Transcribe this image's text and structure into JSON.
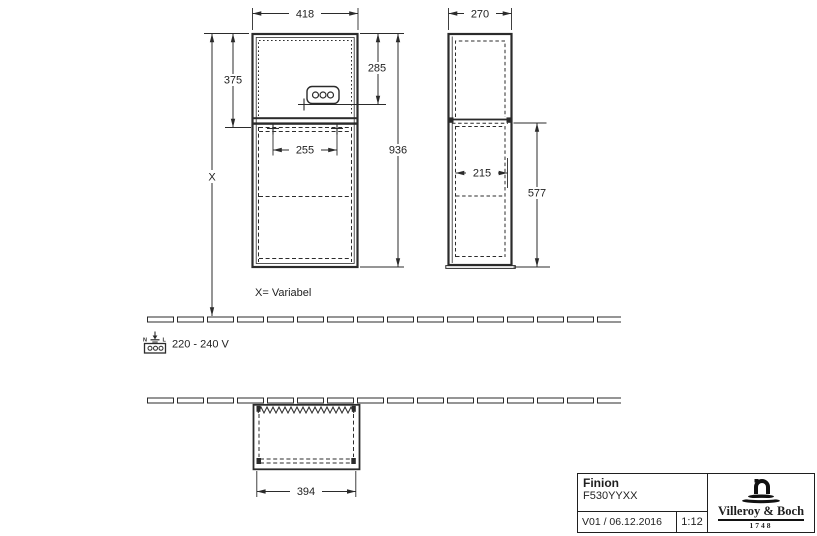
{
  "drawing": {
    "front_view": {
      "width_mm": "418",
      "upper_section_height_mm": "375",
      "socket_from_top_mm": "285",
      "total_height_mm": "936",
      "hole_spacing_mm": "255",
      "floor_distance_label": "X",
      "variable_note": "X= Variabel"
    },
    "side_view": {
      "depth_mm": "270",
      "inner_depth_mm": "215",
      "lower_section_height_mm": "577"
    },
    "plan_view": {
      "inner_width_mm": "394"
    },
    "power_supply": {
      "voltage_label": "220 - 240 V",
      "terminal_n": "N",
      "terminal_l": "L"
    },
    "colors": {
      "line": "#2b2b2b",
      "background": "#ffffff"
    }
  },
  "title_block": {
    "product_name": "Finion",
    "article_number": "F530YYXX",
    "version_date": "V01 / 06.12.2016",
    "scale": "1:12",
    "brand_name": "Villeroy & Boch",
    "brand_year": "1748"
  }
}
